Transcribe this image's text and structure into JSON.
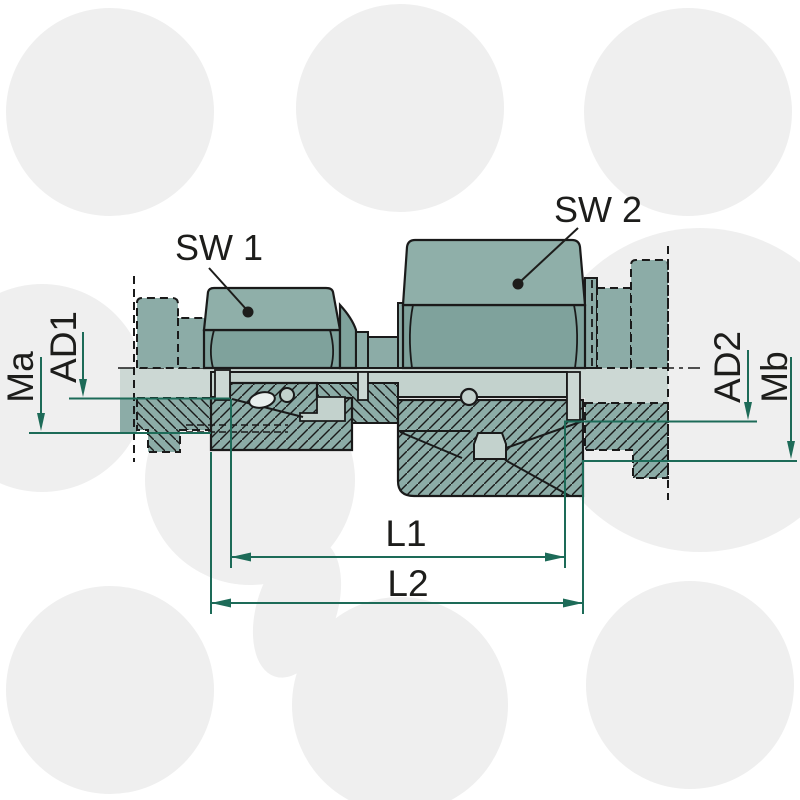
{
  "diagram": {
    "type": "technical-drawing",
    "subject": "straight tube coupling cross-section",
    "labels": {
      "sw1": "SW 1",
      "sw2": "SW 2",
      "ma": "Ma",
      "ad1": "AD1",
      "ad2": "AD2",
      "mb": "Mb",
      "l1": "L1",
      "l2": "L2"
    },
    "colors": {
      "body_teal_top": "#8fafa9",
      "body_teal_flank": "#7fa29c",
      "body_teal_mid": "#8caca7",
      "bore_light": "#ccd8d4",
      "tube_light": "#c3d2cd",
      "ring_white": "#e9efed",
      "outline_black": "#1a1a1a",
      "dimension_green": "#1d6b58",
      "background_circle": "#efefef"
    }
  }
}
